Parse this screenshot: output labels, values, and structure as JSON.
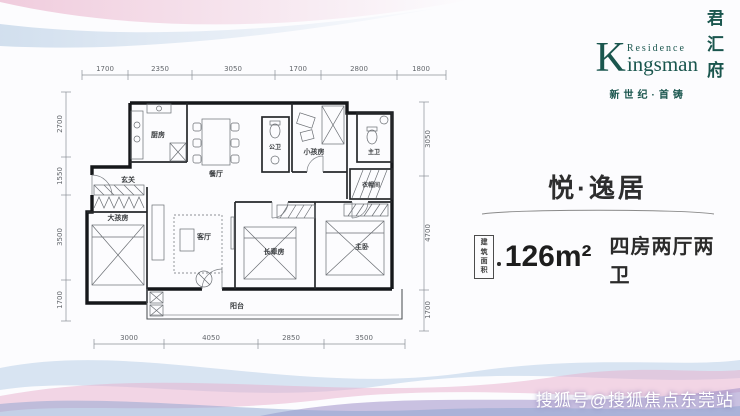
{
  "brand": {
    "k": "K",
    "residence": "Residence",
    "ingsman": "ingsman",
    "cn_chars": [
      "君",
      "汇",
      "府"
    ],
    "tagline": "新世纪·首铸",
    "brand_color": "#1a564e"
  },
  "unit": {
    "title": "悦·逸居",
    "area_badge": [
      "建筑",
      "面积"
    ],
    "area_value": "126m²",
    "rooms_spec": "四房两厅两卫"
  },
  "floorplan": {
    "rooms": {
      "kitchen": "厨房",
      "dining": "餐厅",
      "guest_bath": "公卫",
      "kids_room": "小孩房",
      "master_bath": "主卫",
      "cloakroom": "衣帽间",
      "entry": "玄关",
      "big_kids_room": "大孩房",
      "living": "客厅",
      "elder_room": "长辈房",
      "master_bedroom": "主卧",
      "balcony": "阳台"
    },
    "dims_top": [
      "1700",
      "2350",
      "3050",
      "1700",
      "2800",
      "1800"
    ],
    "dims_bottom": [
      "3000",
      "4050",
      "2850",
      "3500"
    ],
    "dims_left": [
      "2700",
      "1550",
      "3500",
      "1700"
    ],
    "dims_right": [
      "3050",
      "4700",
      "1700"
    ]
  },
  "watermark": "搜狐号@搜狐焦点东莞站",
  "colors": {
    "brand_teal": "#1a564e",
    "ink": "#2b2b2b",
    "wave_pink": "#e8aecb",
    "wave_blue": "#b9d0e8",
    "wave_purple": "#9e90c9"
  }
}
